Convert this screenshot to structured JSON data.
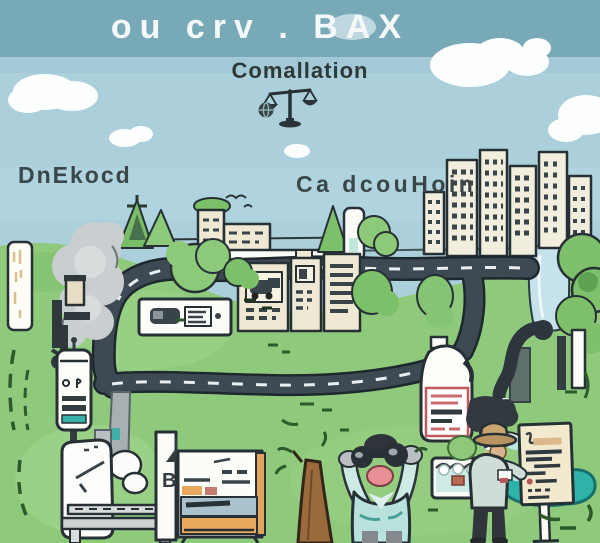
{
  "illustration": {
    "title": "ou crv . BAX",
    "subtitle": "Comallation",
    "label_left": "DnEkocd",
    "label_right": "Ca dcouHoin",
    "easel_letter": "B"
  },
  "icons": [
    {
      "name": "scales-of-justice-icon",
      "meaning": "balance scale"
    },
    {
      "name": "globe-icon",
      "meaning": "small dark globe beside the scale"
    }
  ],
  "scene_objects": [
    "sky band",
    "clouds",
    "city skyline",
    "pine trees",
    "roads with dashed lines",
    "river",
    "cream buildings",
    "vehicle sign",
    "smoke plume",
    "factory machinery",
    "meter kiosk",
    "white machine with platform",
    "easel board",
    "tree trunk",
    "observer with binoculars",
    "water jug with red label",
    "faucet pipe",
    "teal pond",
    "notice sign",
    "water trough",
    "field researcher with hat"
  ],
  "colors": {
    "sky_band": "#77a9b7",
    "sky": "#abd0dc",
    "cloud": "#fdfefe",
    "title_text": "#f5f8f8",
    "dark_text": "#31403f",
    "grass": "#8fca7c",
    "road": "#3d4a53",
    "road_dash": "#e9eef0",
    "building_cream": "#efe8d2",
    "tree_green": "#7fc06c",
    "river": "#c6e2ea",
    "teal_water": "#2eb3a9",
    "smoke_gray": "#c9ced1",
    "orange_accent": "#e8a85e",
    "board_blue": "#a9c2cd",
    "shirt_teal": "#b9e2dc",
    "trunk_brown": "#9a6a3d",
    "label_red": "#bf5a5e",
    "sign_cream": "#f3e9cf",
    "hat_tan": "#c9a56f"
  }
}
